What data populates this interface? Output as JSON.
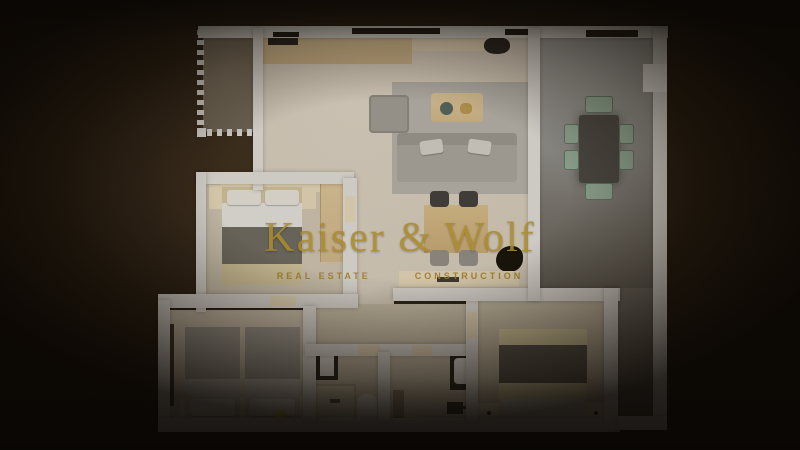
{
  "watermark": {
    "title": "Kaiser & Wolf",
    "subtitle_left": "REAL ESTATE",
    "subtitle_right": "CONSTRUCTION"
  },
  "palette": {
    "background_center": "#47381f",
    "background_edge": "#0b0804",
    "wall": "#dcdbd6",
    "floor_living": "#d3cabb",
    "floor_hall": "#c7bda9",
    "floor_bedroom": "#cbc2b0",
    "floor_bed3": "#c3b9a4",
    "floor_terrace_top": "#a3a3a1",
    "floor_terrace_bottom": "#5b5852",
    "floor_balcony": "#6e6557",
    "rug": "#b2afa8",
    "sofa": "#a6a39d",
    "wood": "#d8c298",
    "bedding_beige": "#cec29c",
    "throw_dark": "#605d55",
    "pillow_white": "#e2e0da",
    "chair_sage": "#8fa896",
    "table_dark": "#474542",
    "accent_gold": "#b6952f",
    "ball_yellow": "#d6d232"
  }
}
